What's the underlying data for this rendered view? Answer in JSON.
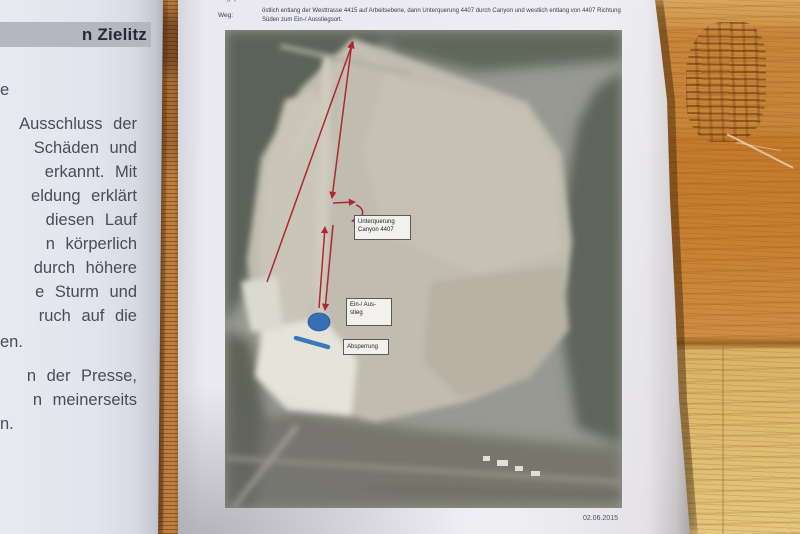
{
  "left_document": {
    "highlighted_header_fragment": "n Zielitz",
    "paragraph1_lines": [
      "e",
      "Ausschluss der",
      "Schäden und",
      "erkannt. Mit",
      "eldung erklärt",
      "diesen Lauf",
      "n körperlich",
      "durch höhere",
      "e Sturm und",
      "ruch auf die",
      "en."
    ],
    "paragraph2_lines": [
      "n der Presse,",
      "n meinerseits",
      "n."
    ]
  },
  "right_document": {
    "top_line_fragment": "Wegeplan Route 3",
    "weg_label": "Weg:",
    "route_description_line1": "östlich entlang der Westtrasse 4415 auf Arbeitsebene, dann Unterquerung 4407 durch Canyon und westlich entlang von 4407 Richtung",
    "route_description_line2": "Süden zum Ein-/ Ausstiegsort.",
    "date": "02.06.2015",
    "map_annotations": {
      "underpass_label_line1": "Unterquerung",
      "underpass_label_line2": "Canyon 4407",
      "entry_exit_label_line1": "Ein-/ Aus-",
      "entry_exit_label_line2": "stieg",
      "barrier_label": "Absperrung"
    }
  },
  "colors": {
    "annotation_red": "#c0202e",
    "annotation_blue": "#2f6fc0",
    "barrier_blue": "#2f7ac5",
    "paper": "#e9e8f0",
    "header_highlight": "#b4b7bf",
    "wood_mid": "#c8863a"
  }
}
